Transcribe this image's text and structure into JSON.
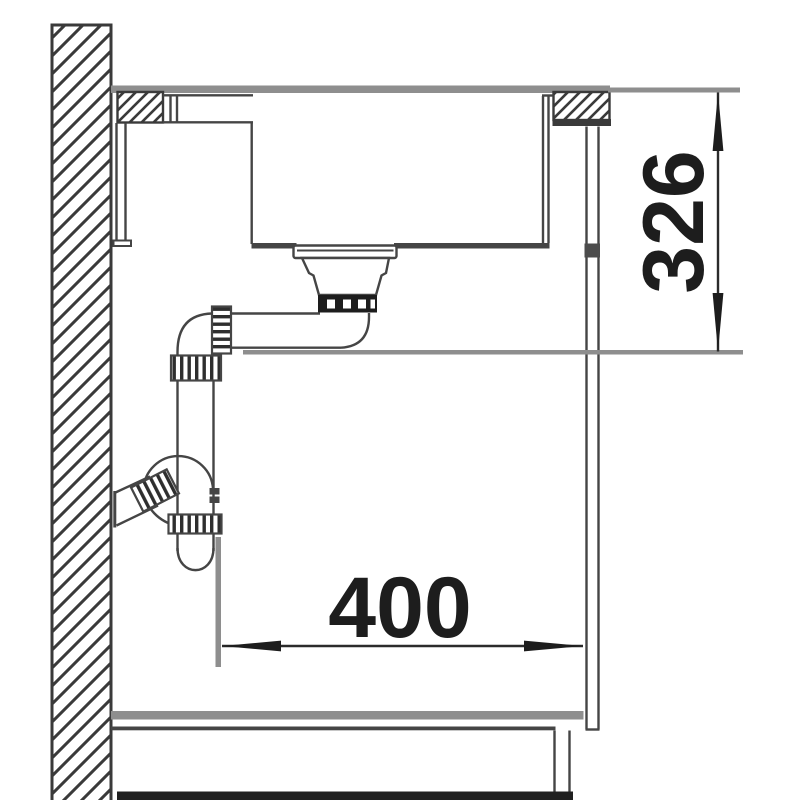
{
  "diagram": {
    "dimensions": {
      "width_label": "400",
      "height_label": "326"
    },
    "colors": {
      "line": "#454545",
      "dark_ink": "#1d1d1d",
      "gray_surface": "#8e8e8e",
      "floor": "#202020",
      "background": "#ffffff"
    }
  }
}
